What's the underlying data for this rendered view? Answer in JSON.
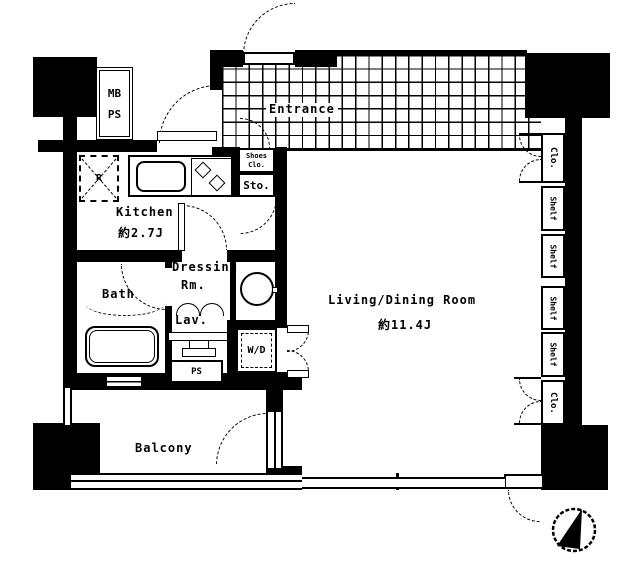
{
  "rooms": {
    "entrance": {
      "label": "Entrance"
    },
    "kitchen": {
      "label": "Kitchen",
      "area": "約2.7J"
    },
    "living_dining": {
      "label": "Living/Dining Room",
      "area": "約11.4J"
    },
    "bath": {
      "label": "Bath"
    },
    "dressing_room": {
      "line1": "Dressing",
      "line2": "Rm."
    },
    "lavatory": {
      "label": "Lav."
    },
    "balcony": {
      "label": "Balcony"
    },
    "storage": {
      "label": "Sto."
    },
    "shoes_closet": {
      "line1": "Shoes",
      "line2": "Clo."
    },
    "meter_box_pipe_space": {
      "line1": "MB",
      "line2": "PS"
    },
    "pipe_space": {
      "label": "PS"
    },
    "washer_dryer": {
      "label": "W/D"
    },
    "refrigerator": {
      "label": "R"
    }
  },
  "storage_units": {
    "closet_top": {
      "label": "Clo."
    },
    "closet_bottom": {
      "label": "Clo."
    },
    "shelves": [
      {
        "label": "Shelf"
      },
      {
        "label": "Shelf"
      },
      {
        "label": "Shelf"
      },
      {
        "label": "Shelf"
      }
    ]
  },
  "colors": {
    "wall": "#000000",
    "background": "#ffffff",
    "line": "#000000"
  }
}
